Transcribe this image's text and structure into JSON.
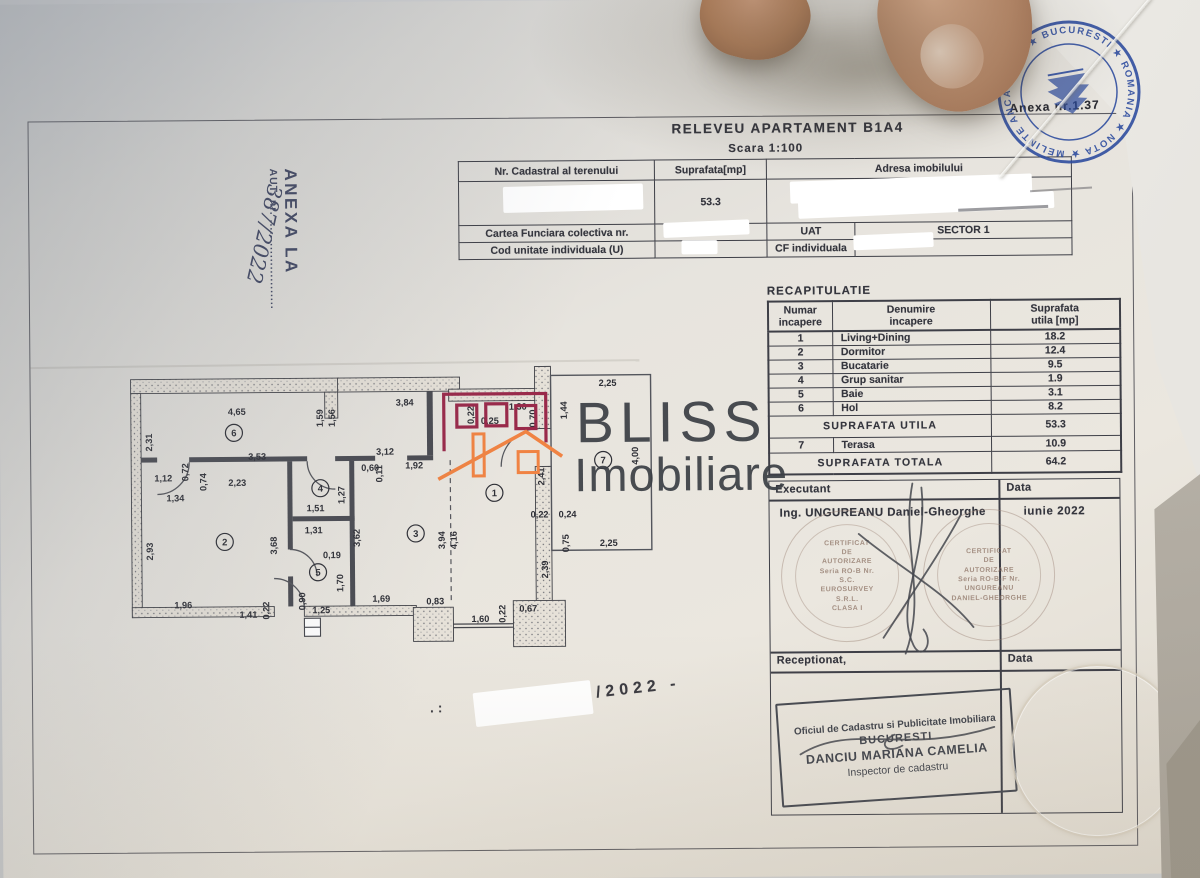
{
  "doc": {
    "title": "RELEVEU  APARTAMENT  B1A4",
    "scale": "Scara 1:100",
    "anexa_note": "Anexa nr.1.37",
    "side_stamp": {
      "line1": "ANEXA LA",
      "line2": "AUT. nr. .......................",
      "handwritten": "387/2022"
    },
    "bottom_note_dots": ". :",
    "bottom_note": "/2022 -"
  },
  "id_table": {
    "h_cadastral": "Nr. Cadastral al terenului",
    "h_suprafata": "Suprafata[mp]",
    "h_adresa": "Adresa imobilului",
    "suprafata_value": "53.3",
    "cartea_label": "Cartea Funciara colectiva nr.",
    "uat_label": "UAT",
    "uat_value": "SECTOR 1",
    "cod_label": "Cod unitate individuala (U)",
    "cf_label": "CF individuala"
  },
  "recap": {
    "title": "RECAPITULATIE",
    "h_numar_1": "Numar",
    "h_numar_2": "incapere",
    "h_denumire_1": "Denumire",
    "h_denumire_2": "incapere",
    "h_supra_1": "Suprafata",
    "h_supra_2": "utila [mp]",
    "rows": [
      [
        "1",
        "Living+Dining",
        "18.2"
      ],
      [
        "2",
        "Dormitor",
        "12.4"
      ],
      [
        "3",
        "Bucatarie",
        "9.5"
      ],
      [
        "4",
        "Grup sanitar",
        "1.9"
      ],
      [
        "5",
        "Baie",
        "3.1"
      ],
      [
        "6",
        "Hol",
        "8.2"
      ]
    ],
    "subtotal_label": "SUPRAFATA UTILA",
    "subtotal_value": "53.3",
    "terasa_row": [
      "7",
      "Terasa",
      "10.9"
    ],
    "total_label": "SUPRAFATA TOTALA",
    "total_value": "64.2"
  },
  "signoff": {
    "executant_label": "Executant",
    "data_label": "Data",
    "executant_name": "Ing. UNGUREANU Daniel-Gheorghe",
    "date_value": "iunie 2022",
    "receptionat_label": "Receptionat,",
    "data_label2": "Data"
  },
  "stamps": {
    "round_left": [
      "CERTIFICAT",
      "DE",
      "AUTORIZARE",
      "Seria RO-B Nr.",
      "S.C.",
      "EUROSURVEY",
      "S.R.L.",
      "CLASA I"
    ],
    "round_right": [
      "CERTIFICAT",
      "DE",
      "AUTORIZARE",
      "Seria RO-B-F Nr.",
      "UNGUREANU",
      "DANIEL-GHEORGHE"
    ],
    "office_stamp": [
      "Oficiul de Cadastru si Publicitate Imobiliara",
      "BUCURESTI",
      "DANCIU MARIANA CAMELIA",
      "Inspector de cadastru"
    ],
    "notary_ring": "★ MELINTE ANCA ELENA ★ BUCURESTI ★ ROMANIA ★ NOTAR PUBLIC",
    "notary_color": "#2b4a9e"
  },
  "logo": {
    "line1": "BLISS",
    "line2": "Imobiliare",
    "orange": "#f08343",
    "maroon": "#99294a",
    "text_color": "#3b3f45"
  },
  "plan": {
    "rooms": [
      {
        "n": "6",
        "x": 107,
        "y": 68
      },
      {
        "n": "2",
        "x": 97,
        "y": 177
      },
      {
        "n": "4",
        "x": 193,
        "y": 124
      },
      {
        "n": "5",
        "x": 190,
        "y": 208
      },
      {
        "n": "3",
        "x": 288,
        "y": 170
      },
      {
        "n": "1",
        "x": 367,
        "y": 130
      },
      {
        "n": "7",
        "x": 476,
        "y": 98
      }
    ],
    "dims": [
      {
        "t": "4,65",
        "x": 110,
        "y": 50,
        "r": 0
      },
      {
        "t": "1,59",
        "x": 196,
        "y": 54,
        "r": -90
      },
      {
        "t": "1,56",
        "x": 208,
        "y": 54,
        "r": -90
      },
      {
        "t": "3,84",
        "x": 278,
        "y": 42,
        "r": 0
      },
      {
        "t": "2,25",
        "x": 481,
        "y": 24,
        "r": 0
      },
      {
        "t": "1,44",
        "x": 440,
        "y": 48,
        "r": -90
      },
      {
        "t": "0,22",
        "x": 347,
        "y": 52,
        "r": -90
      },
      {
        "t": "0,25",
        "x": 363,
        "y": 61,
        "r": 0
      },
      {
        "t": "1,30",
        "x": 391,
        "y": 47,
        "r": 0
      },
      {
        "t": "0,70",
        "x": 409,
        "y": 56,
        "r": -90
      },
      {
        "t": "2,41",
        "x": 417,
        "y": 114,
        "r": -90
      },
      {
        "t": "2,31",
        "x": 25,
        "y": 77,
        "r": -90
      },
      {
        "t": "1,12",
        "x": 36,
        "y": 116,
        "r": 0
      },
      {
        "t": "0,72",
        "x": 61,
        "y": 107,
        "r": -90
      },
      {
        "t": "0,74",
        "x": 79,
        "y": 117,
        "r": -90
      },
      {
        "t": "3,53",
        "x": 130,
        "y": 95,
        "r": 0
      },
      {
        "t": "2,23",
        "x": 110,
        "y": 121,
        "r": 0
      },
      {
        "t": "1,34",
        "x": 48,
        "y": 136,
        "r": 0
      },
      {
        "t": "2,93",
        "x": 25,
        "y": 186,
        "r": -90
      },
      {
        "t": "3,12",
        "x": 258,
        "y": 91,
        "r": 0
      },
      {
        "t": "0,60",
        "x": 243,
        "y": 107,
        "r": 0
      },
      {
        "t": "0,11",
        "x": 255,
        "y": 110,
        "r": -90
      },
      {
        "t": "1,92",
        "x": 287,
        "y": 105,
        "r": 0
      },
      {
        "t": "1,51",
        "x": 188,
        "y": 147,
        "r": 0
      },
      {
        "t": "1,27",
        "x": 217,
        "y": 131,
        "r": -90
      },
      {
        "t": "3,68",
        "x": 149,
        "y": 181,
        "r": -90
      },
      {
        "t": "3,62",
        "x": 232,
        "y": 174,
        "r": -90
      },
      {
        "t": "1,31",
        "x": 186,
        "y": 169,
        "r": 0
      },
      {
        "t": "0,19",
        "x": 204,
        "y": 194,
        "r": 0
      },
      {
        "t": "1,70",
        "x": 215,
        "y": 219,
        "r": -90
      },
      {
        "t": "0,90",
        "x": 177,
        "y": 237,
        "r": -90
      },
      {
        "t": "1,25",
        "x": 193,
        "y": 249,
        "r": 0
      },
      {
        "t": "3,94",
        "x": 317,
        "y": 177,
        "r": -90
      },
      {
        "t": "4,16",
        "x": 329,
        "y": 177,
        "r": -90
      },
      {
        "t": "1,96",
        "x": 55,
        "y": 243,
        "r": 0
      },
      {
        "t": "1,41",
        "x": 120,
        "y": 253,
        "r": 0
      },
      {
        "t": "0,22",
        "x": 141,
        "y": 246,
        "r": -90
      },
      {
        "t": "1,69",
        "x": 253,
        "y": 238,
        "r": 0
      },
      {
        "t": "0,83",
        "x": 307,
        "y": 241,
        "r": 0
      },
      {
        "t": "1,60",
        "x": 352,
        "y": 259,
        "r": 0
      },
      {
        "t": "0,22",
        "x": 377,
        "y": 251,
        "r": -90
      },
      {
        "t": "0,67",
        "x": 400,
        "y": 249,
        "r": 0
      },
      {
        "t": "2,39",
        "x": 420,
        "y": 207,
        "r": -90
      },
      {
        "t": "0,22",
        "x": 412,
        "y": 155,
        "r": 0
      },
      {
        "t": "0,24",
        "x": 440,
        "y": 155,
        "r": 0
      },
      {
        "t": "0,75",
        "x": 441,
        "y": 181,
        "r": -90
      },
      {
        "t": "2,25",
        "x": 481,
        "y": 184,
        "r": 0
      },
      {
        "t": "4,00",
        "x": 511,
        "y": 94,
        "r": -90
      }
    ]
  }
}
